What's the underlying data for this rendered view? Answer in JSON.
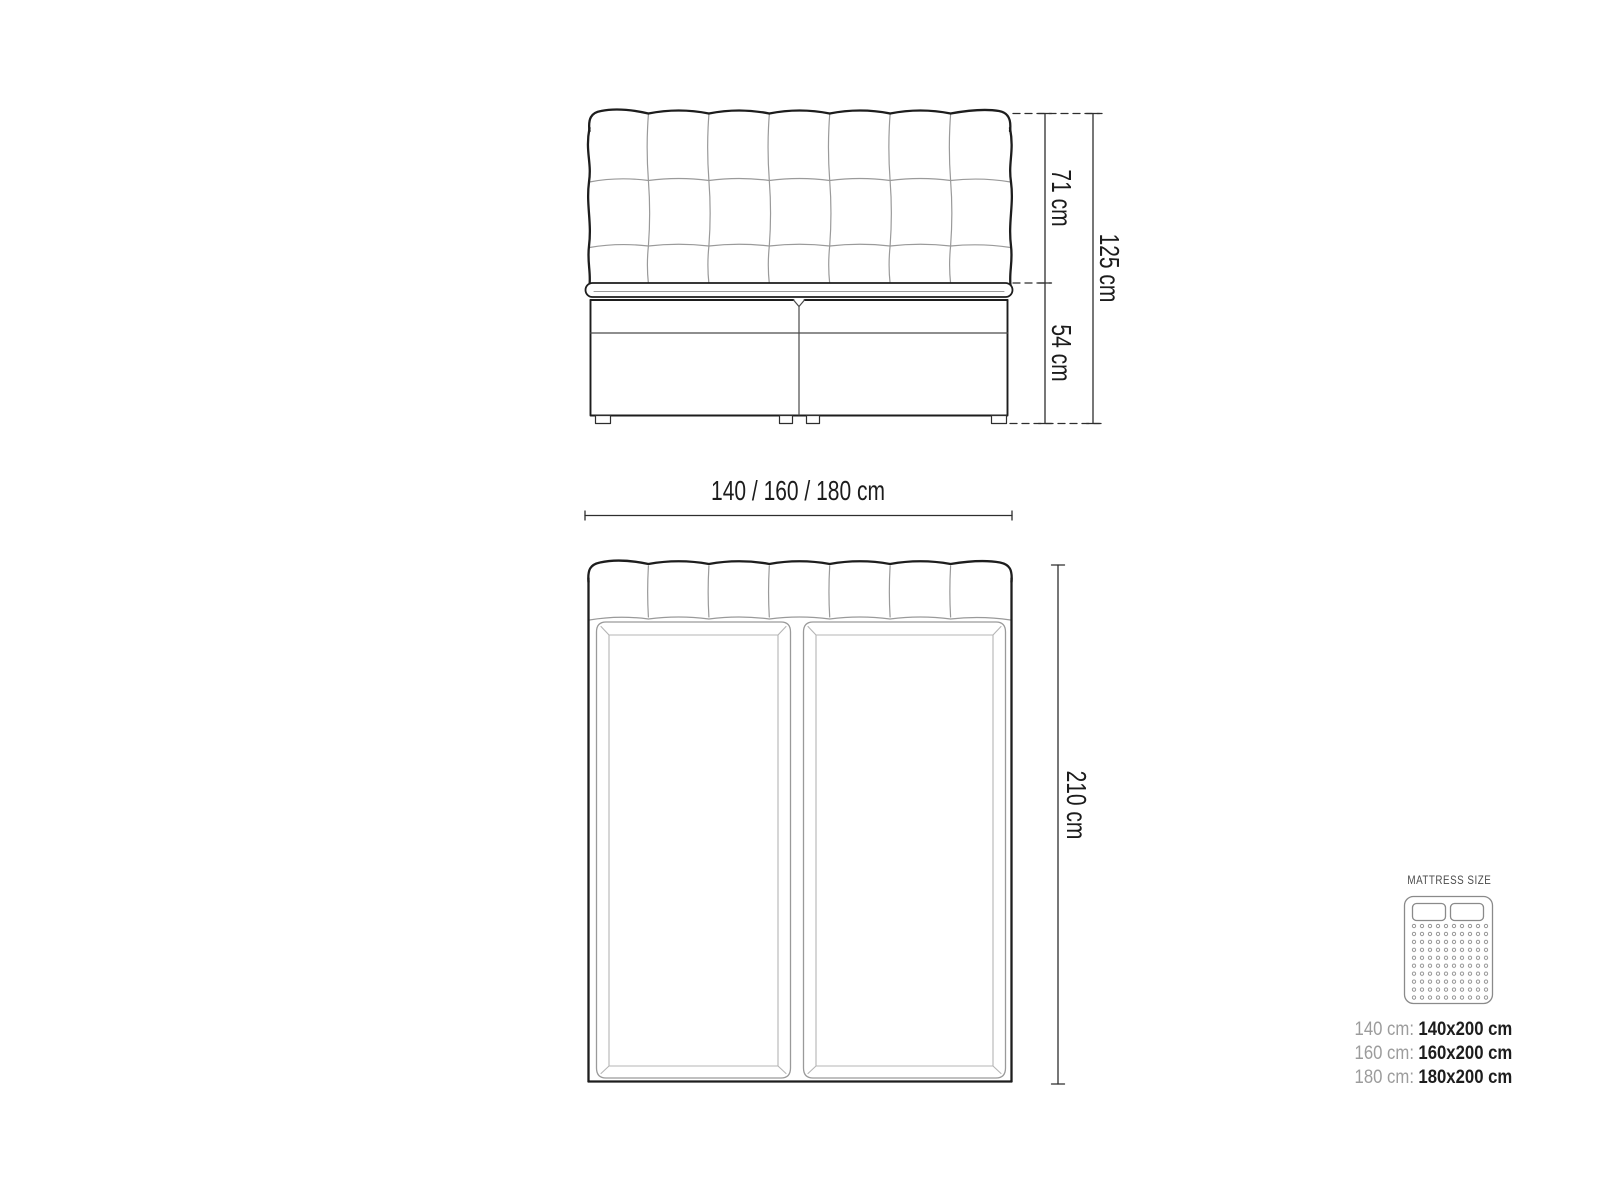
{
  "front_view": {
    "height_headboard": "71 cm",
    "height_base": "54 cm",
    "height_total": "125 cm",
    "width_options": "140 / 160 / 180 cm"
  },
  "top_view": {
    "length": "210 cm"
  },
  "legend": {
    "title": "MATTRESS SIZE",
    "rows": [
      {
        "label": "140 cm:",
        "value": "140x200 cm"
      },
      {
        "label": "160 cm:",
        "value": "160x200 cm"
      },
      {
        "label": "180 cm:",
        "value": "180x200 cm"
      }
    ]
  },
  "colors": {
    "outline": "#1d1d1d",
    "light_line": "#9a9a9a",
    "inner_line": "#b5b5b5",
    "dimension_line": "#2e2e2e",
    "legend_icon": "#8a8a8a",
    "legend_muted": "#9c9c9c",
    "legend_strong": "#1d1d1d",
    "background": "#ffffff"
  }
}
